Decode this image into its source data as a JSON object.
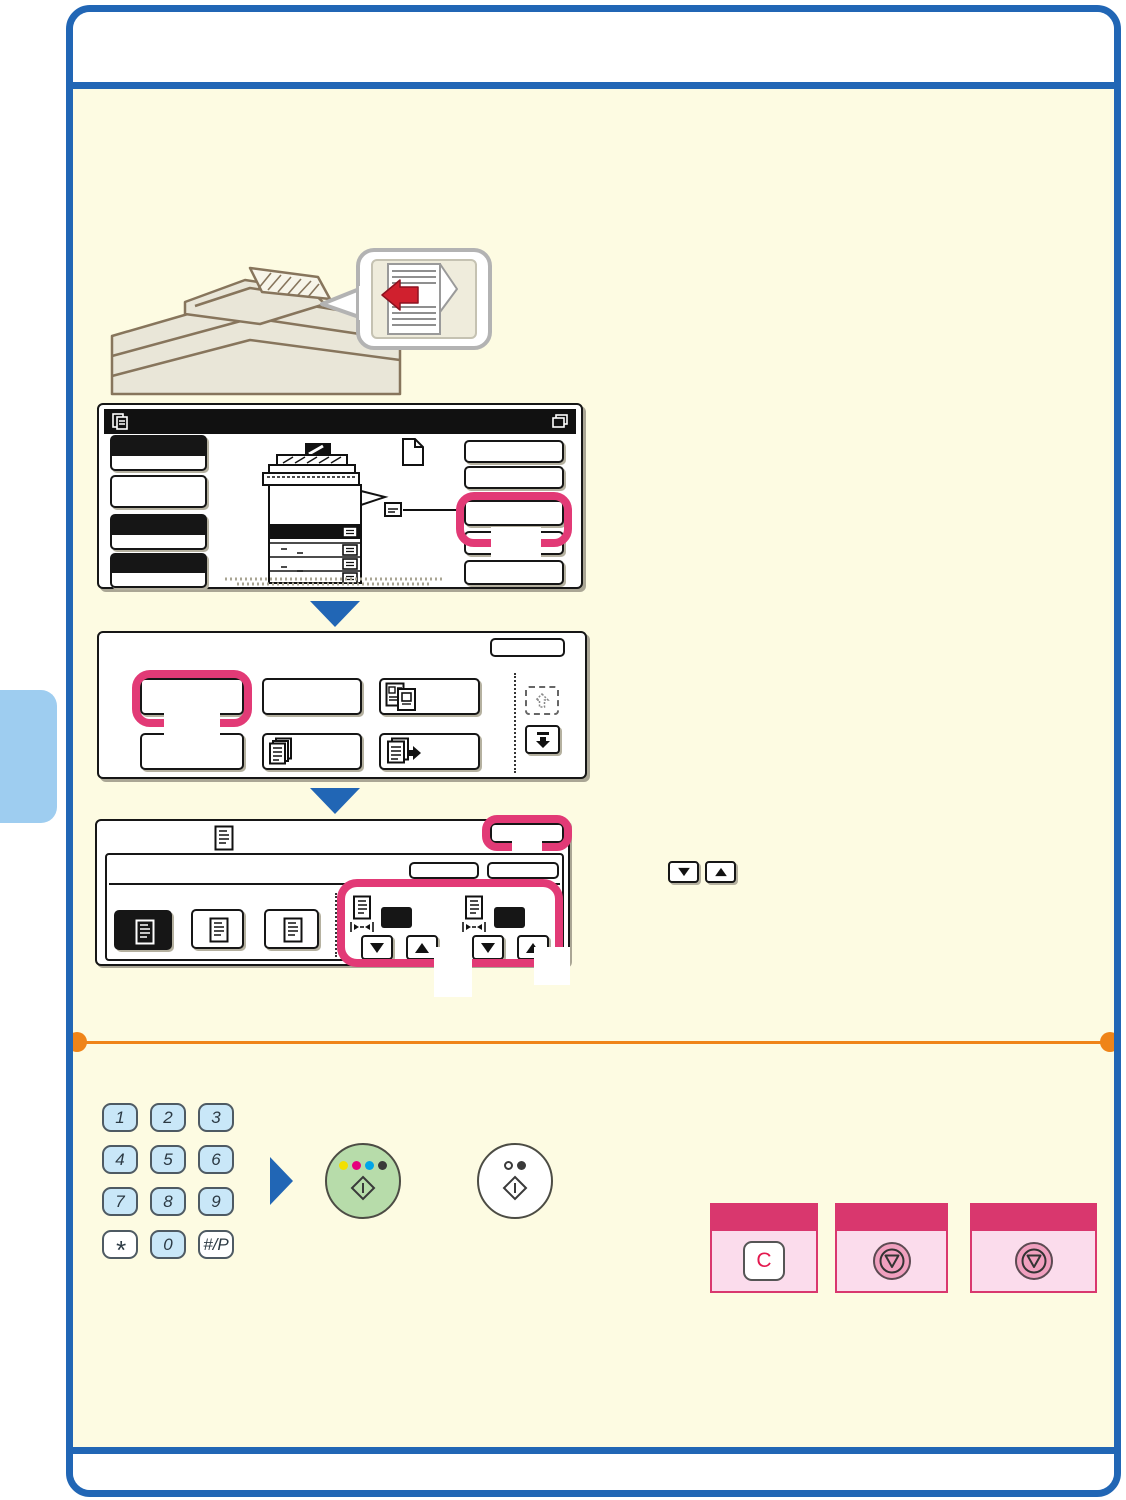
{
  "document_type": "copier-operation-guide-page",
  "colors": {
    "frame_blue": "#2166b5",
    "content_bg": "#fdfbe2",
    "highlight_pink": "#e23a76",
    "rule_orange": "#ef8418",
    "side_tab_blue": "#9ecdf0",
    "keypad_key_blue": "#c9e7f8",
    "color_start_green": "#b7dcaa",
    "card_header_pink": "#d9376e",
    "card_body_pink": "#fbdcec",
    "stop_key_pink": "#f0a0bf",
    "clear_key_red": "#e3184e",
    "callout_arrow_red": "#d0202e",
    "start_dot_colors": [
      "#f2e000",
      "#e6007d",
      "#00a6e8",
      "#3a3a3a"
    ]
  },
  "keypad": {
    "keys": [
      {
        "label": "1"
      },
      {
        "label": "2"
      },
      {
        "label": "3"
      },
      {
        "label": "4"
      },
      {
        "label": "5"
      },
      {
        "label": "6"
      },
      {
        "label": "7"
      },
      {
        "label": "8"
      },
      {
        "label": "9"
      },
      {
        "label": "*"
      },
      {
        "label": "0"
      },
      {
        "label": "#/P"
      }
    ]
  },
  "hard_keys": {
    "clear_key_label": "C"
  },
  "icons": [
    "copier-feeder-illustration",
    "original-orientation-callout",
    "red-left-arrow-icon",
    "copy-mode-icon",
    "job-status-icon",
    "machine-tray-illustration",
    "page-icon",
    "original-indicator-icon",
    "hand-feed-icon",
    "id-card-copy-icon",
    "sort-copies-icon",
    "file-pages-icon",
    "scroll-up-icon",
    "scroll-down-icon",
    "original-size-icon",
    "ratio-width-icon",
    "down-arrow-icon",
    "up-arrow-icon",
    "color-start-icon",
    "bw-start-icon",
    "stop-icon"
  ]
}
